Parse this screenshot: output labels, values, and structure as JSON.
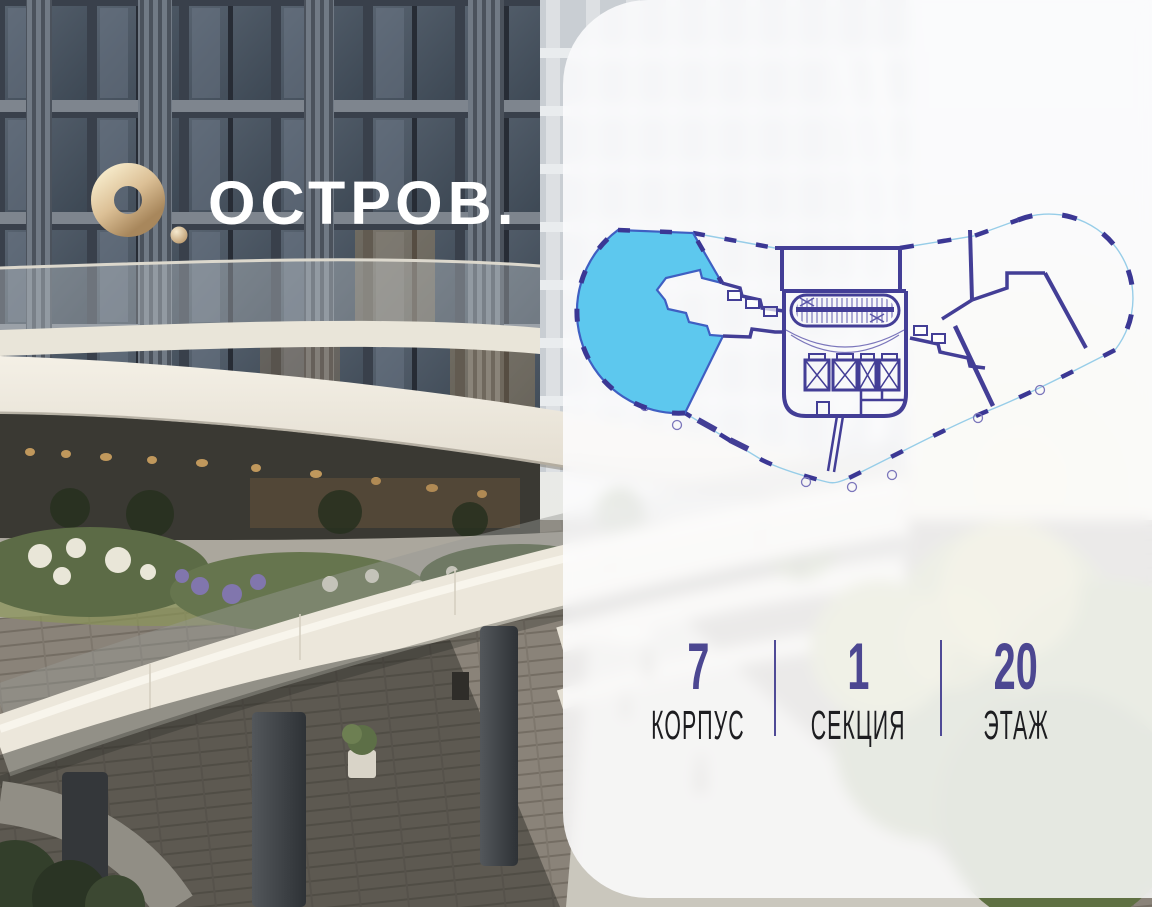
{
  "brand": {
    "logo_text": "ОСТРОВ.",
    "icon": "gold-ring-icon",
    "text_color": "#ffffff",
    "gold_color": "#d9bd92"
  },
  "floor_plan": {
    "selected_apartment": "left-wing-apartment",
    "selected_apartment_color": "#5dc8ee",
    "selected_apartment_outline": "#3f5fc2",
    "wall_color": "#433e96",
    "outline_color": "#97cde8",
    "window_dash_color": "#3b3794"
  },
  "info_bar": {
    "value_color": "#4c4791",
    "label_color": "#1d1d20",
    "divider_color": "#4f4a96",
    "items": [
      {
        "id": "korpus",
        "value": "7",
        "label": "КОРПУС"
      },
      {
        "id": "sekciya",
        "value": "1",
        "label": "СЕКЦИЯ"
      },
      {
        "id": "etazh",
        "value": "20",
        "label": "ЭТАЖ"
      }
    ]
  },
  "panel": {
    "background": "rgba(253,253,254,0.85)"
  }
}
